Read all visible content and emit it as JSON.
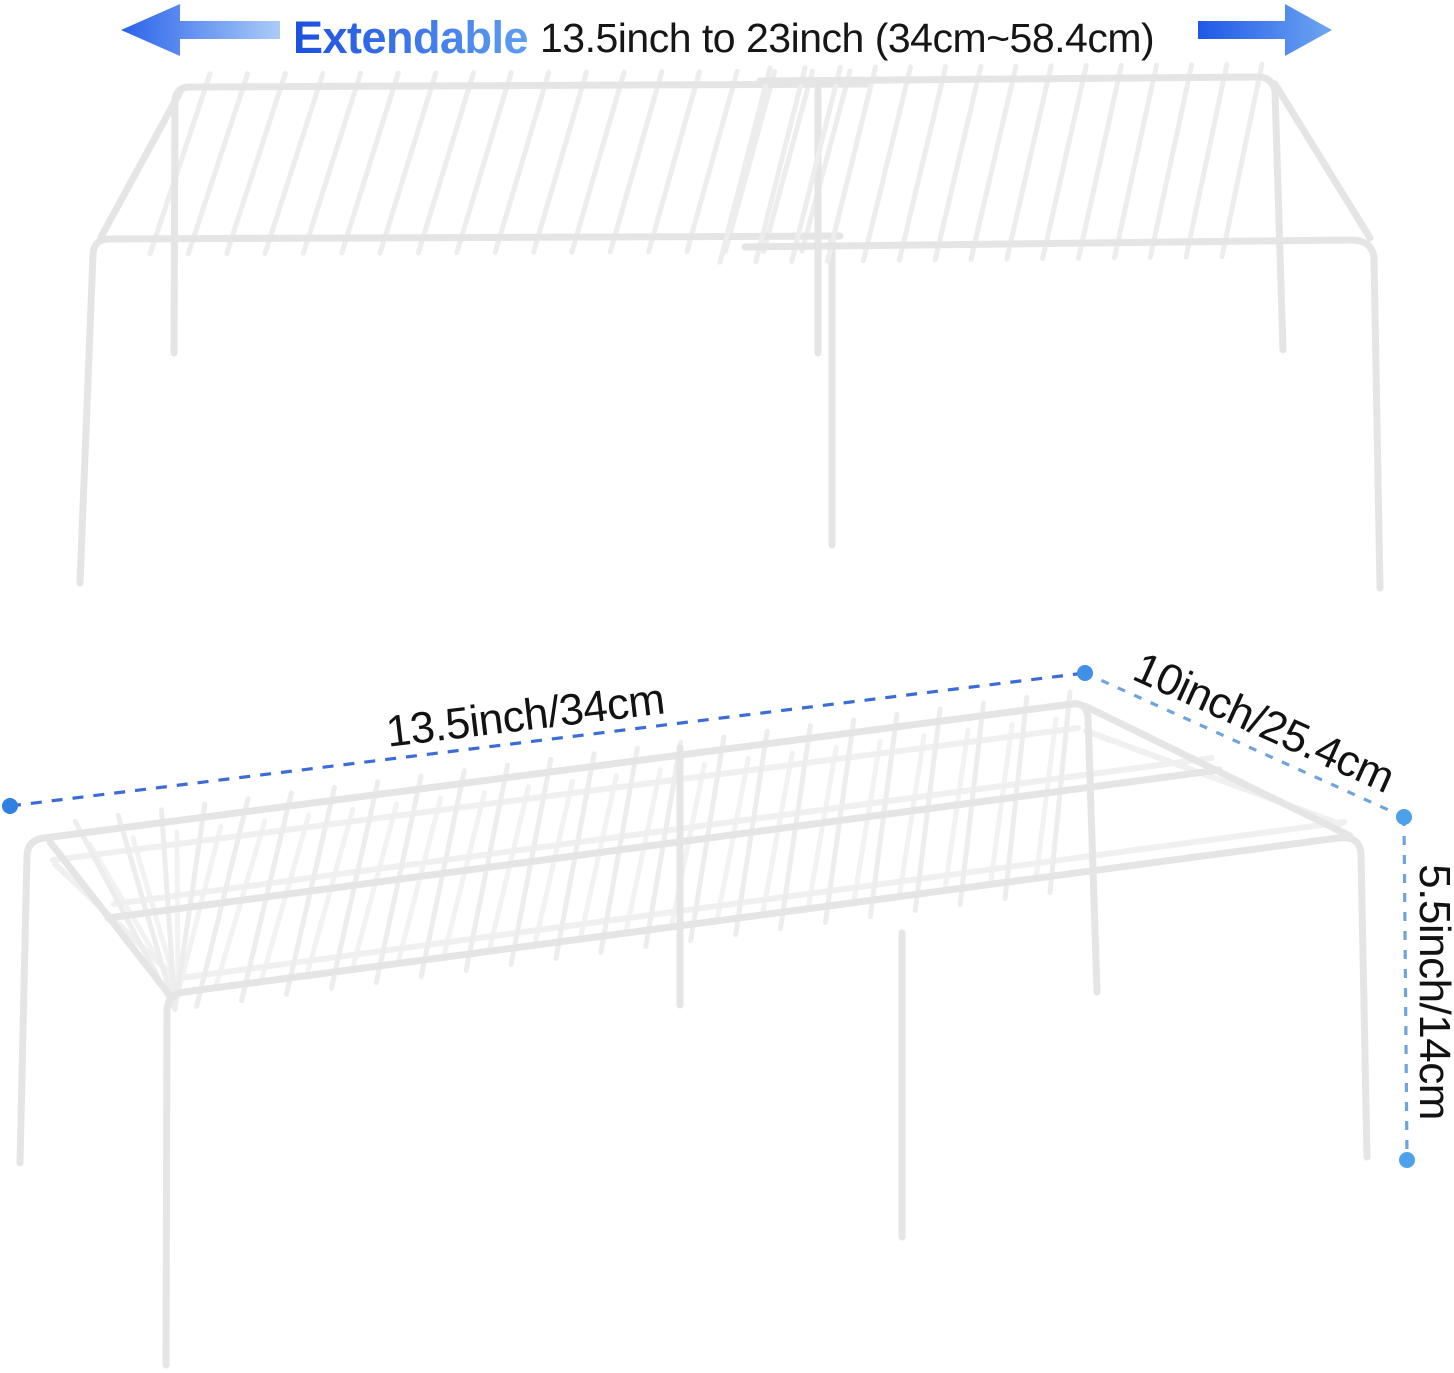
{
  "header": {
    "highlight": "Extendable",
    "range_text": "13.5inch to 23inch (34cm~58.4cm)"
  },
  "dimensions": {
    "length_label": "13.5inch/34cm",
    "depth_label": "10inch/25.4cm",
    "height_label": "5.5inch/14cm"
  },
  "colors": {
    "arrow_dark": "#2256e8",
    "arrow_light": "#abccf8",
    "highlight_dark": "#1b4fe0",
    "highlight_light": "#63a2f3",
    "body_text": "#161616",
    "dash_primary": "#3c6cd7",
    "dash_secondary": "#6fa3dc",
    "dot_fill": "#3f90e6",
    "wire_main": "#ededed",
    "wire_light": "#f2f2f2",
    "frame_main": "#e5e5e5",
    "frame_light": "#f0f0f0"
  }
}
